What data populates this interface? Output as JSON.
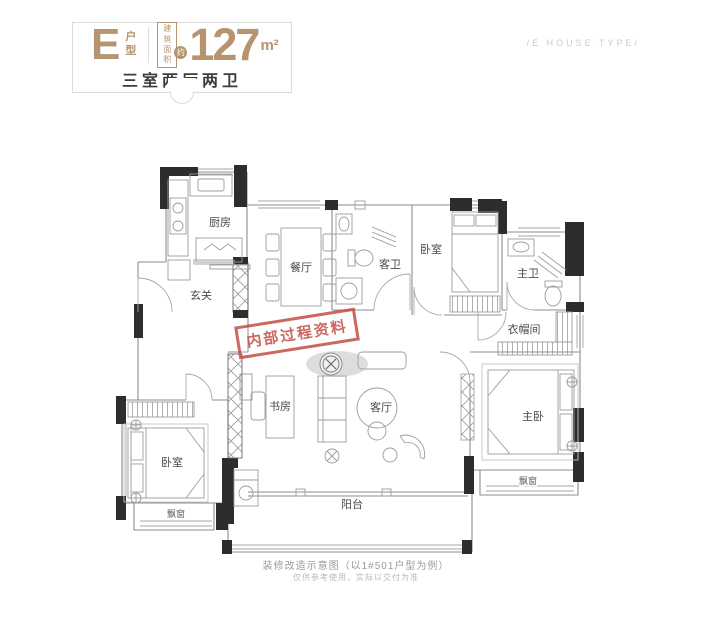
{
  "header": {
    "type_letter": "E",
    "type_label": "户型",
    "area_caption": "建筑面积",
    "area_approx": "约",
    "area_value": "127",
    "area_unit": "m²",
    "layout_summary": "三室两厅两卫",
    "subtitle_en": "/E HOUSE TYPE/"
  },
  "rooms": {
    "kitchen": "厨房",
    "dining": "餐厅",
    "foyer": "玄关",
    "guest_bath": "客卫",
    "bedroom_top": "卧室",
    "master_bath": "主卫",
    "cloakroom": "衣帽间",
    "study": "书房",
    "living": "客厅",
    "master": "主卧",
    "bedroom_left": "卧室",
    "bay_left": "飘窗",
    "bay_right": "飘窗",
    "balcony": "阳台"
  },
  "stamp": {
    "text": "内部过程资料"
  },
  "footer": {
    "caption": "装修改造示意图（以1#501户型为例）",
    "note": "仅供参考使用，实际以交付为准"
  },
  "colors": {
    "accent_gold": "#b5946f",
    "wall_dark": "#2d2d2d",
    "stamp_red": "#c2473e",
    "caption_gray": "#9a9a9a"
  }
}
